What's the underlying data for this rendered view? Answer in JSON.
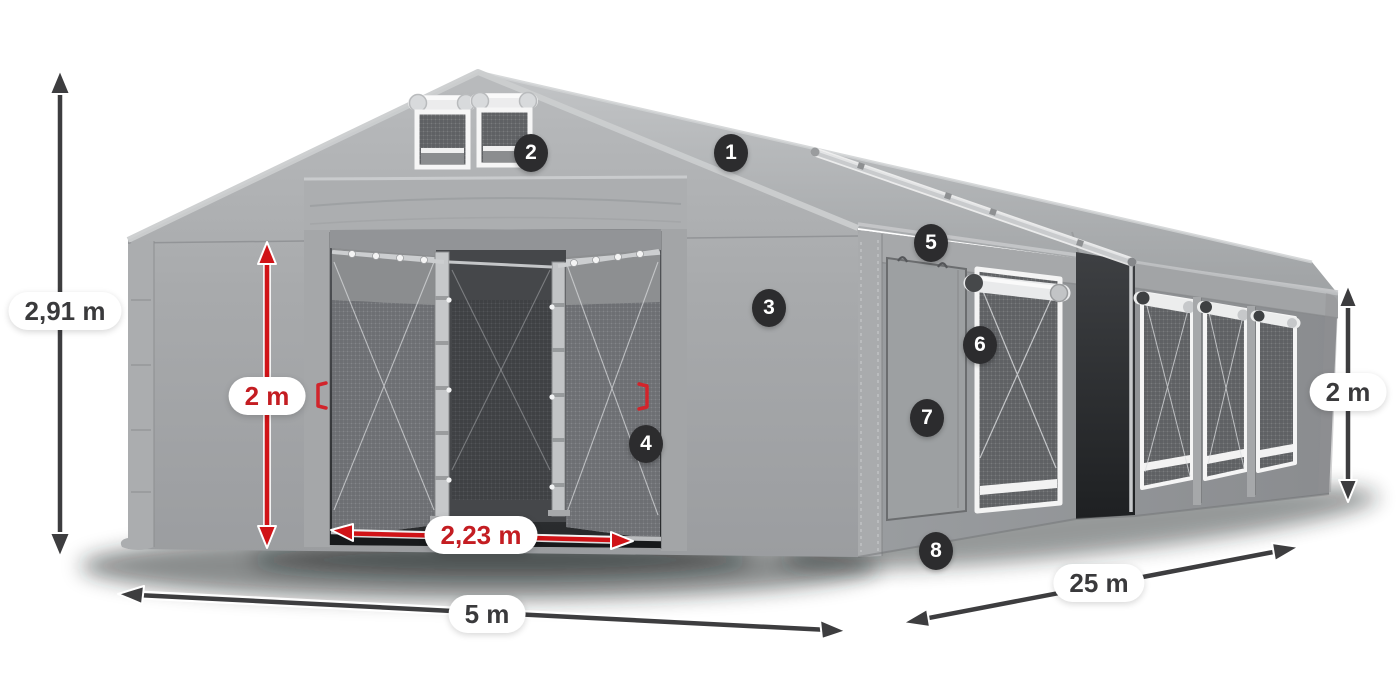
{
  "dimensions": {
    "total_height": "2,91 m",
    "door_height": "2 m",
    "door_width": "2,23 m",
    "front_width": "5 m",
    "side_length": "25 m",
    "side_wall_height": "2 m"
  },
  "callouts": [
    "1",
    "2",
    "3",
    "4",
    "5",
    "6",
    "7",
    "8"
  ],
  "colors": {
    "accent_red": "#d01317",
    "arrow_dark": "#3d3d3f",
    "badge_bg": "#2c2c2e",
    "badge_text": "#ffffff",
    "label_dark": "#3a3a3c",
    "label_red": "#c41d22",
    "pill_bg": "#ffffff",
    "tent_gray": "#9fa1a3"
  }
}
